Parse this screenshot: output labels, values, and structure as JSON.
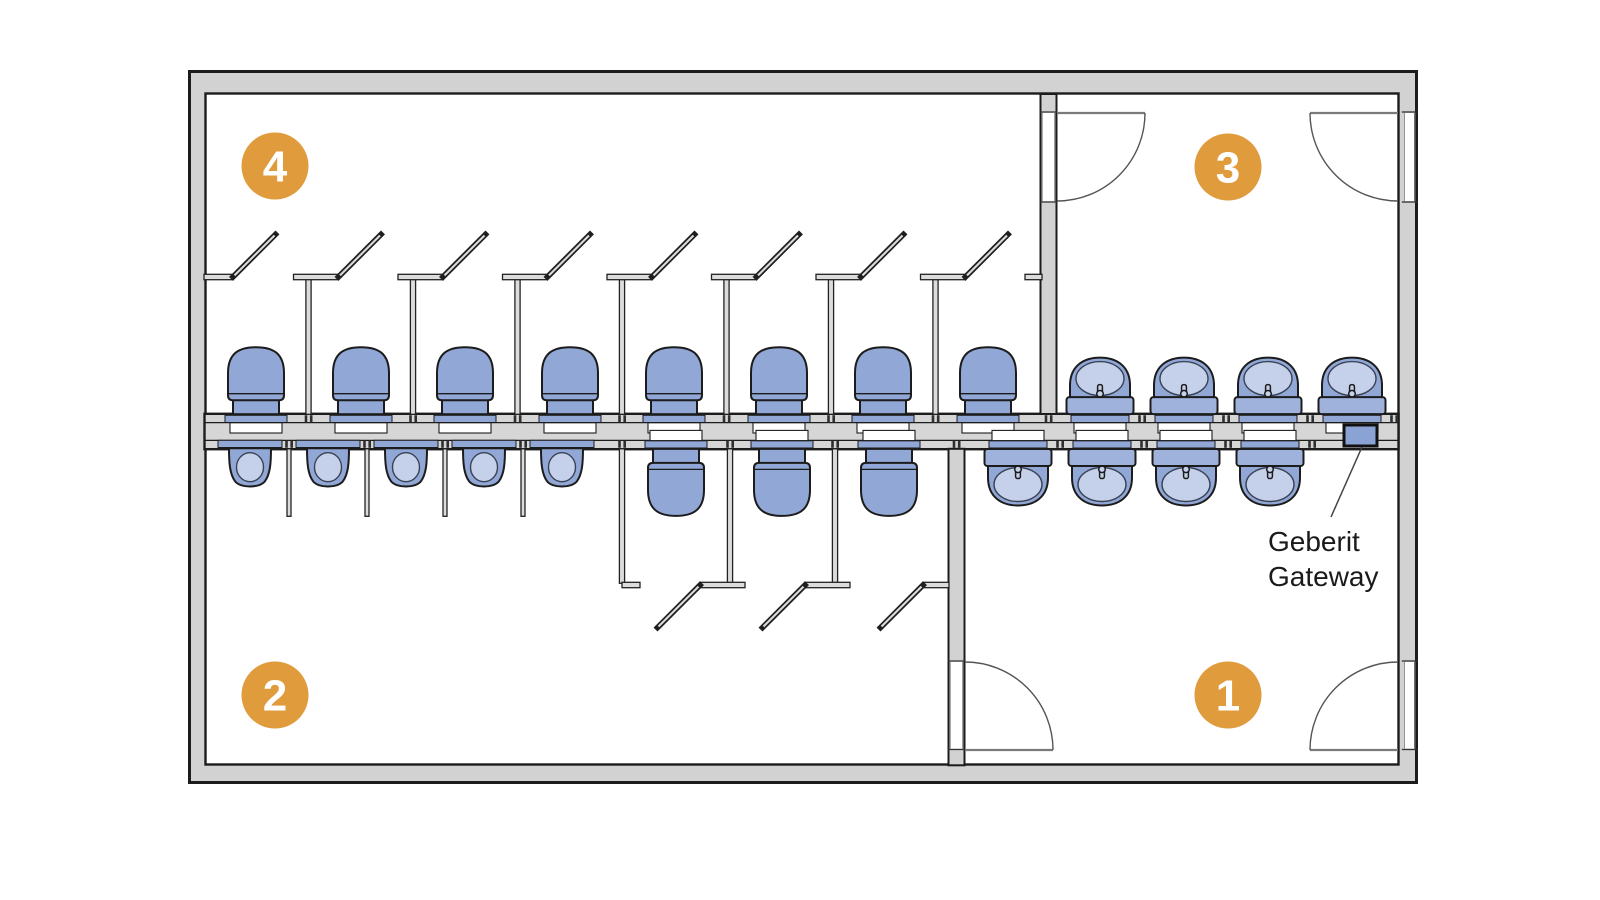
{
  "page": {
    "background": "#FFFFFF",
    "width": 1600,
    "height": 900
  },
  "diagram": {
    "kind": "floor-plan",
    "subject": "Sanitary facility floor plan with four numbered zones and a Geberit Gateway on the installation wall",
    "colors": {
      "badge": "#E09B3D",
      "badge_text": "#FFFFFF",
      "fixture": "#91A7D6",
      "fixture_light": "#C5D1EA",
      "counter": "#9FB2DC",
      "wall_fill": "#D2D2D2",
      "band_fill": "#D6D6D6",
      "line": "#1C1C1C",
      "partition_core": "#DCDCDC",
      "door_arc": "#555555"
    },
    "zones": [
      {
        "number": "1",
        "cx": 1228,
        "cy": 695
      },
      {
        "number": "2",
        "cx": 275,
        "cy": 695
      },
      {
        "number": "3",
        "cx": 1228,
        "cy": 167
      },
      {
        "number": "4",
        "cx": 275,
        "cy": 166
      }
    ],
    "fixtures": {
      "toilets_top": [
        256,
        361,
        465,
        570,
        674,
        779,
        883,
        988
      ],
      "toilets_bottom": [
        676,
        782,
        889
      ],
      "urinals": [
        250,
        328,
        406,
        484,
        562
      ],
      "basins_top": [
        1100,
        1184,
        1268,
        1352
      ],
      "basins_bottom": [
        1018,
        1102,
        1186,
        1270
      ]
    },
    "stalls_top": {
      "front_y": 277,
      "leaf_len": 42.5,
      "partitions": [
        308.5,
        413,
        517.5,
        622,
        726.5,
        831,
        935.5
      ],
      "wall_segments": [
        [
          204,
          233
        ],
        [
          293.5,
          338.5
        ],
        [
          398,
          443
        ],
        [
          502.5,
          547.5
        ],
        [
          607,
          652
        ],
        [
          711.5,
          756.5
        ],
        [
          816,
          861
        ],
        [
          920.5,
          965.5
        ],
        [
          1025,
          1042
        ]
      ],
      "door_hinges": [
        233,
        338.5,
        443,
        547.5,
        652,
        756.5,
        861,
        965.5
      ]
    },
    "stalls_bottom": {
      "front_y": 585,
      "leaf_len": 42.5,
      "partitions": [
        622,
        730,
        835
      ],
      "wall_segments": [
        [
          622,
          640
        ],
        [
          700,
          745
        ],
        [
          805,
          850
        ],
        [
          923,
          949
        ]
      ],
      "door_hinges": [
        700,
        805,
        923
      ]
    },
    "urinal_screens": [
      289,
      367,
      445,
      523
    ],
    "ticks_top": [
      308.5,
      413,
      517.5,
      622,
      726.5,
      831,
      935.5,
      1048.5,
      1142,
      1226,
      1310,
      1394
    ],
    "ticks_bottom": [
      289,
      367,
      445,
      523,
      622,
      730,
      835,
      956.5,
      1060,
      1144,
      1228,
      1312
    ],
    "doors": [
      {
        "name": "room3-left-door",
        "hinge": [
          1057,
          113
        ],
        "tip": [
          1145,
          113
        ],
        "end": [
          1057,
          201
        ],
        "sweep": 1
      },
      {
        "name": "room3-right-door",
        "hinge": [
          1398,
          113
        ],
        "tip": [
          1310,
          113
        ],
        "end": [
          1398,
          201
        ],
        "sweep": 0
      },
      {
        "name": "room1-left-door",
        "hinge": [
          965,
          750
        ],
        "tip": [
          1053,
          750
        ],
        "end": [
          965,
          662
        ],
        "sweep": 0
      },
      {
        "name": "room1-right-door",
        "hinge": [
          1398,
          750
        ],
        "tip": [
          1310,
          750
        ],
        "end": [
          1398,
          662
        ],
        "sweep": 1
      }
    ],
    "openings": [
      {
        "wall": "A",
        "x": 1041.6,
        "w": 14,
        "y1": 112,
        "y2": 202
      },
      {
        "wall": "B",
        "x": 949.6,
        "w": 14,
        "y1": 661,
        "y2": 749.5
      },
      {
        "wall": "right",
        "x": 1403.8,
        "w": 11.5,
        "y1": 112,
        "y2": 202
      },
      {
        "wall": "right",
        "x": 1403.8,
        "w": 11.5,
        "y1": 661,
        "y2": 749.5
      }
    ],
    "gateway": {
      "label_line1": "Geberit",
      "label_line2": "Gateway",
      "label_x": 1268,
      "label_y1": 551,
      "label_y2": 586,
      "box": {
        "x": 1344,
        "y": 425,
        "w": 33,
        "h": 21
      },
      "leader": {
        "x1": 1362,
        "y1": 447,
        "x2": 1331,
        "y2": 517
      }
    }
  }
}
